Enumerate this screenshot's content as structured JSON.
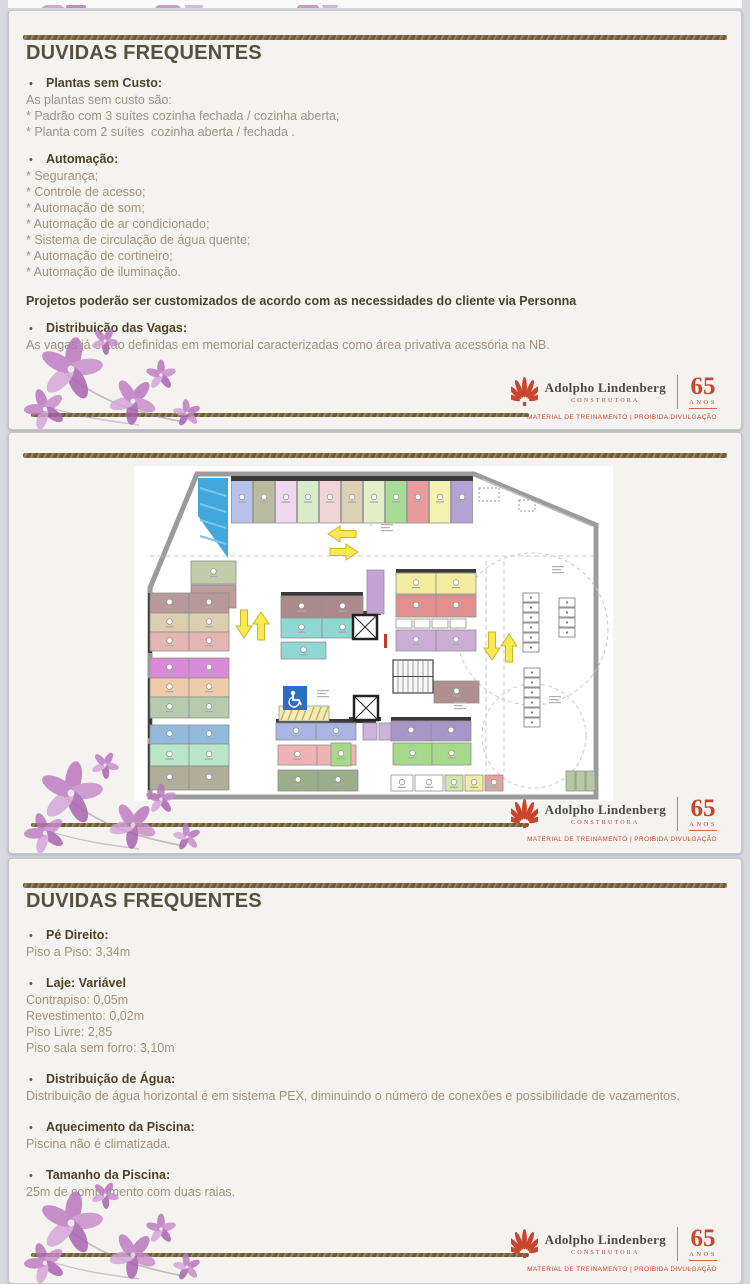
{
  "slide1": {
    "title": "DUVIDAS FREQUENTES",
    "sections": [
      {
        "label": "Plantas sem Custo:",
        "lines": [
          "As plantas sem custo são:",
          "* Padrão com 3 suítes cozinha fechada / cozinha aberta;",
          "* Planta com 2 suítes  cozinha aberta / fechada ."
        ]
      },
      {
        "label": "Automação:",
        "lines": [
          "* Segurança;",
          "* Controle de acesso;",
          "* Automação de som;",
          "* Automação de ar condicionado;",
          "* Sistema de circulação de água quente;",
          "* Automação de cortineiro;",
          "* Automação de iluminação."
        ]
      },
      {
        "note": "Projetos poderão ser customizados de acordo com as necessidades do cliente via Personna"
      },
      {
        "label": "Distribuição das Vagas:",
        "lines": [
          "As vagas já estão definidas em memorial caracterizadas como área privativa acessória na NB."
        ]
      }
    ]
  },
  "slide3": {
    "title": "DUVIDAS FREQUENTES",
    "sections": [
      {
        "label": "Pé Direito:",
        "lines": [
          "Piso a Piso: 3,34m"
        ]
      },
      {
        "label": "Laje: Variável",
        "lines": [
          "Contrapiso: 0,05m",
          "Revestimento: 0,02m",
          "Piso Livre: 2,85",
          "Piso sala sem forro: 3,10m"
        ]
      },
      {
        "label": "Distribuição de Água:",
        "lines": [
          "Distribuição de água horizontal é em sistema PEX, diminuindo o número de conexões e possibilidade de vazamentos."
        ]
      },
      {
        "label": "Aquecimento da Piscina:",
        "lines": [
          "Piscina não é climatizada."
        ]
      },
      {
        "label": "Tamanho da Piscina:",
        "lines": [
          "25m de comprimento com duas raias."
        ]
      }
    ]
  },
  "logo": {
    "name": "Adolpho Lindenberg",
    "subtitle": "CONSTRUTORA",
    "years": "65",
    "anos": "ANOS",
    "footer": "MATERIAL DE TREINAMENTO | PROIBIDA DIVULGAÇÃO",
    "red": "#c9452e"
  },
  "decor": {
    "gold": "#8a7350",
    "flower_colors": [
      "#b671bb",
      "#c78bca",
      "#a75fae",
      "#d4a3d8",
      "#bd7ac2"
    ],
    "flower_center": "#f0e6ee"
  },
  "plan": {
    "wall_color": "#9b9b9b",
    "boundary": "63,8 340,8 462,59 462,331 16,331 16,122",
    "ramp": {
      "points": "64,12 94,12 94,92 64,50",
      "color": "#41a7dd"
    },
    "top_row": {
      "x": 97,
      "y": 12,
      "w": 22,
      "h": 45,
      "colors": [
        "#b7c1e9",
        "#b9bc9f",
        "#eed7ef",
        "#d9ecca",
        "#f2d4d4",
        "#dcd1b6",
        "#e4eec9",
        "#a9dc95",
        "#e89c9c",
        "#f5f1ae",
        "#b2a2d5"
      ]
    },
    "cells": [
      [
        57,
        95,
        45,
        23,
        "#c3cba9"
      ],
      [
        57,
        119,
        45,
        23,
        "#bd9c9d"
      ],
      [
        16,
        127,
        39,
        20,
        "#b9989a"
      ],
      [
        55,
        127,
        40,
        20,
        "#b9989a"
      ],
      [
        16,
        147,
        39,
        19,
        "#ddceb0"
      ],
      [
        55,
        147,
        40,
        19,
        "#ddceb0"
      ],
      [
        16,
        166,
        39,
        19,
        "#e4b5b1"
      ],
      [
        55,
        166,
        40,
        19,
        "#e4b5b1"
      ],
      [
        16,
        192,
        39,
        20,
        "#d88ad8"
      ],
      [
        55,
        192,
        40,
        20,
        "#d88ad8"
      ],
      [
        16,
        212,
        39,
        19,
        "#eeccaa"
      ],
      [
        55,
        212,
        40,
        19,
        "#eeccaa"
      ],
      [
        16,
        231,
        39,
        21,
        "#b4cbae"
      ],
      [
        55,
        231,
        40,
        21,
        "#b4cbae"
      ],
      [
        16,
        259,
        39,
        19,
        "#92badd"
      ],
      [
        55,
        259,
        40,
        19,
        "#92badd"
      ],
      [
        16,
        278,
        39,
        22,
        "#b9e5c8"
      ],
      [
        55,
        278,
        40,
        22,
        "#b9e5c8"
      ],
      [
        16,
        300,
        39,
        24,
        "#b0ad98"
      ],
      [
        55,
        300,
        40,
        24,
        "#b0ad98"
      ],
      [
        147,
        130,
        41,
        22,
        "#ab8a8c"
      ],
      [
        188,
        130,
        41,
        22,
        "#ab8a8c"
      ],
      [
        147,
        152,
        41,
        20,
        "#8ed7d3"
      ],
      [
        188,
        152,
        41,
        20,
        "#8ed7d3"
      ],
      [
        147,
        176,
        45,
        17,
        "#8ed7d3"
      ],
      [
        142,
        257,
        40,
        17,
        "#a9b5e3"
      ],
      [
        182,
        257,
        40,
        17,
        "#a9b5e3"
      ],
      [
        229,
        257,
        14,
        17,
        "#cbb3dd"
      ],
      [
        245,
        257,
        14,
        17,
        "#cbb3dd"
      ],
      [
        144,
        279,
        39,
        20,
        "#efb3b3"
      ],
      [
        183,
        279,
        39,
        20,
        "#efb3b3"
      ],
      [
        144,
        304,
        40,
        21,
        "#9aae8c"
      ],
      [
        184,
        304,
        40,
        21,
        "#9aae8c"
      ],
      [
        233,
        104,
        17,
        44,
        "#c5a3d4"
      ],
      [
        262,
        107,
        40,
        21,
        "#f2ec9e"
      ],
      [
        302,
        107,
        40,
        21,
        "#f2ec9e"
      ],
      [
        262,
        129,
        40,
        22,
        "#e28f8f"
      ],
      [
        302,
        129,
        40,
        22,
        "#e28f8f"
      ],
      [
        262,
        153,
        16,
        9,
        "#ffffff"
      ],
      [
        280,
        153,
        16,
        9,
        "#ffffff"
      ],
      [
        298,
        153,
        16,
        9,
        "#ffffff"
      ],
      [
        316,
        153,
        16,
        9,
        "#ffffff"
      ],
      [
        262,
        164,
        40,
        21,
        "#cbaed6"
      ],
      [
        302,
        164,
        40,
        21,
        "#cbaed6"
      ],
      [
        300,
        215,
        45,
        22,
        "#b08f90"
      ],
      [
        257,
        255,
        40,
        20,
        "#a894c6"
      ],
      [
        297,
        255,
        40,
        20,
        "#a894c6"
      ],
      [
        197,
        277,
        20,
        23,
        "#a6d98a"
      ],
      [
        259,
        277,
        39,
        22,
        "#a6d98a"
      ],
      [
        298,
        277,
        39,
        22,
        "#a6d98a"
      ],
      [
        257,
        309,
        22,
        16,
        "#ffffff"
      ],
      [
        281,
        309,
        28,
        16,
        "#ffffff"
      ],
      [
        311,
        309,
        18,
        16,
        "#cfe7ac"
      ],
      [
        331,
        309,
        18,
        16,
        "#f1eca1"
      ],
      [
        351,
        309,
        18,
        16,
        "#e4a0a0"
      ],
      [
        432,
        305,
        9,
        20,
        "#b5c9a2"
      ],
      [
        442,
        305,
        9,
        20,
        "#b5c9a2"
      ],
      [
        452,
        305,
        9,
        20,
        "#b5c9a2"
      ]
    ],
    "blocks": [
      [
        97,
        10,
        242,
        5
      ],
      [
        147,
        126,
        82,
        4
      ],
      [
        262,
        103,
        80,
        4
      ],
      [
        142,
        253,
        100,
        4
      ],
      [
        257,
        251,
        80,
        4
      ],
      [
        215,
        145,
        32,
        4
      ],
      [
        215,
        251,
        32,
        4
      ],
      [
        14,
        127,
        4,
        60
      ],
      [
        14,
        212,
        4,
        60
      ],
      [
        14,
        278,
        4,
        46
      ]
    ],
    "hatch": [
      145,
      240,
      50,
      15
    ],
    "handicap": [
      149,
      220,
      24,
      24
    ],
    "handicap_color": "#2a6fc0",
    "elevators": [
      [
        219,
        149,
        24
      ],
      [
        220,
        230,
        24
      ]
    ],
    "stairs": [
      259,
      194,
      40,
      33
    ],
    "moto": [
      [
        389,
        127,
        6
      ],
      [
        390,
        202,
        6
      ],
      [
        425,
        132,
        4
      ]
    ],
    "circles": [
      [
        398,
        163,
        76
      ],
      [
        400,
        270,
        52
      ]
    ],
    "dash_lines": [
      [
        16,
        90,
        460,
        90
      ],
      [
        352,
        95,
        352,
        305
      ],
      [
        370,
        95,
        370,
        305
      ],
      [
        237,
        10,
        237,
        60
      ]
    ],
    "dashed_rects": [
      [
        345,
        22,
        20,
        13
      ],
      [
        385,
        34,
        16,
        11
      ]
    ],
    "arrows": [
      [
        222,
        68,
        180
      ],
      [
        196,
        86,
        0
      ],
      [
        110,
        144,
        90
      ],
      [
        127,
        174,
        270
      ],
      [
        358,
        166,
        90
      ],
      [
        375,
        196,
        270
      ]
    ],
    "red_marks": [
      [
        250,
        168,
        3,
        14
      ]
    ],
    "notes": [
      [
        247,
        58
      ],
      [
        183,
        224
      ],
      [
        320,
        236
      ],
      [
        418,
        100
      ],
      [
        415,
        230
      ],
      [
        352,
        318
      ]
    ]
  }
}
